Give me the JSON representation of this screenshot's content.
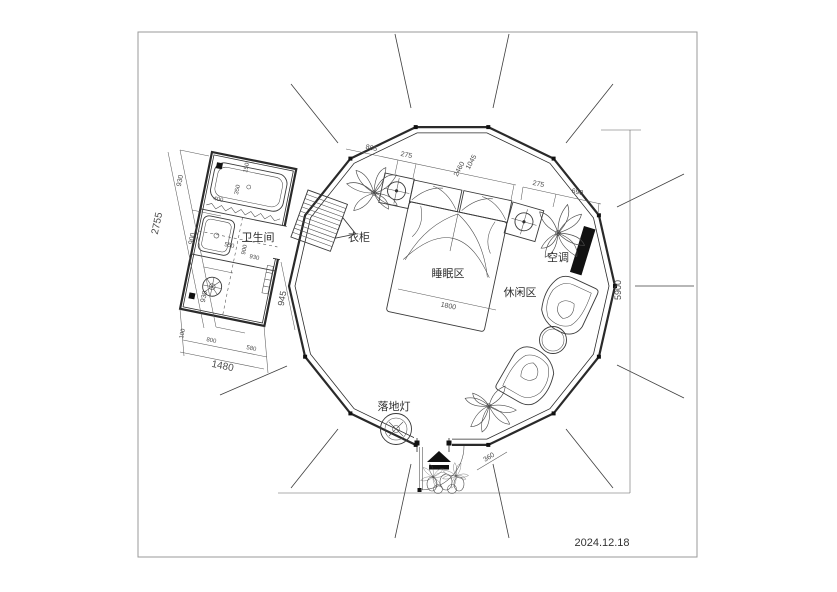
{
  "drawing": {
    "date": "2024.12.18",
    "labels": {
      "bathroom": "卫生间",
      "wardrobe": "衣柜",
      "sleeping_area": "睡眠区",
      "leisure_area": "休闲区",
      "air_conditioner": "空调",
      "floor_lamp": "落地灯"
    },
    "dimensions": {
      "overall_height": "5900",
      "top_chain": [
        "805",
        "275",
        "2460",
        "1045",
        "275",
        "690"
      ],
      "bed_width": "1800",
      "entrance_width": "360",
      "bathroom": {
        "total_length": "2755",
        "left_segments": [
          "930",
          "900",
          "930"
        ],
        "total_width": "1480",
        "bottom_segments": [
          "100",
          "800",
          "580"
        ],
        "door_opening": "945",
        "inner": [
          "400",
          "350",
          "150",
          "550",
          "900",
          "930"
        ]
      }
    },
    "colors": {
      "ink": "#2e2e2e",
      "wall": "#2a2a2a",
      "dim": "#555555",
      "fill_black": "#111111",
      "frame": "#9a9a9a",
      "background": "#ffffff"
    }
  }
}
